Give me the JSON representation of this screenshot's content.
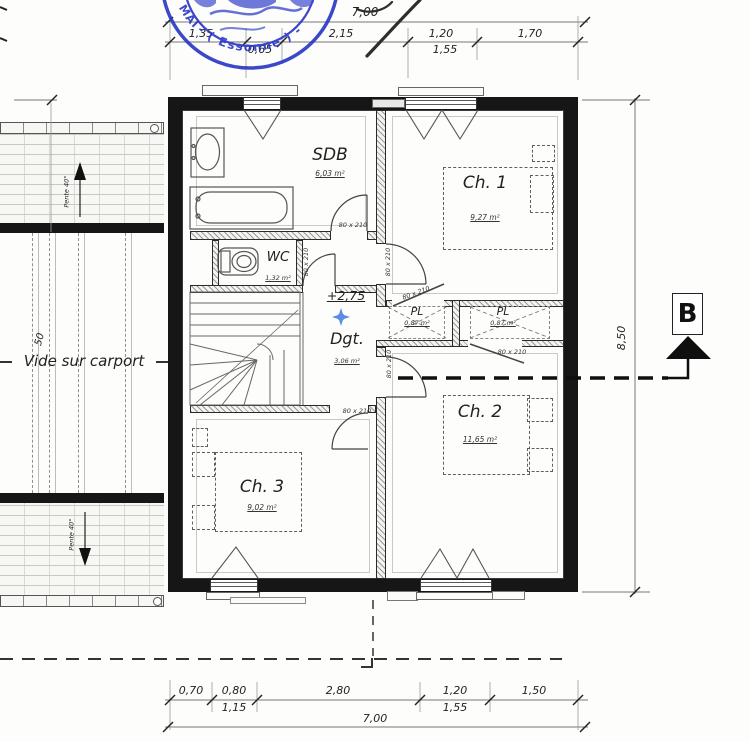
{
  "stamp": {
    "arc_text": "- ( Essonne ) -",
    "left_text": "MAI",
    "color": "#2835c5"
  },
  "dimensions": {
    "top": {
      "overall": "7,00",
      "chain": [
        "1,35",
        "2,15",
        "1,20",
        "1,70"
      ],
      "sub": [
        "0,65",
        "1,55"
      ]
    },
    "bottom": {
      "overall": "7,00",
      "chain": [
        "0,70",
        "0,80",
        "2,80",
        "1,20",
        "1,50"
      ],
      "sub": [
        "1,15",
        "1,55"
      ]
    },
    "right": {
      "overall": "8,50"
    }
  },
  "rooms": {
    "sdb": {
      "name": "SDB",
      "area": "6,03 m²"
    },
    "wc": {
      "name": "WC",
      "area": "1,32 m²"
    },
    "dgt": {
      "name": "Dgt.",
      "area": "3,06 m²"
    },
    "ch1": {
      "name": "Ch. 1",
      "area": "9,27 m²"
    },
    "ch2": {
      "name": "Ch. 2",
      "area": "11,65 m²"
    },
    "ch3": {
      "name": "Ch. 3",
      "area": "9,02 m²"
    },
    "pl1": {
      "name": "PL",
      "area": "0,87 m²"
    },
    "pl2": {
      "name": "PL",
      "area": "0,87 m²"
    }
  },
  "annotations": {
    "level": "+2,75",
    "door_size": "80 x 210",
    "void_label": "Vide sur carport",
    "void_width": "50",
    "slope": "Pente 40°",
    "section_marker": "B"
  }
}
